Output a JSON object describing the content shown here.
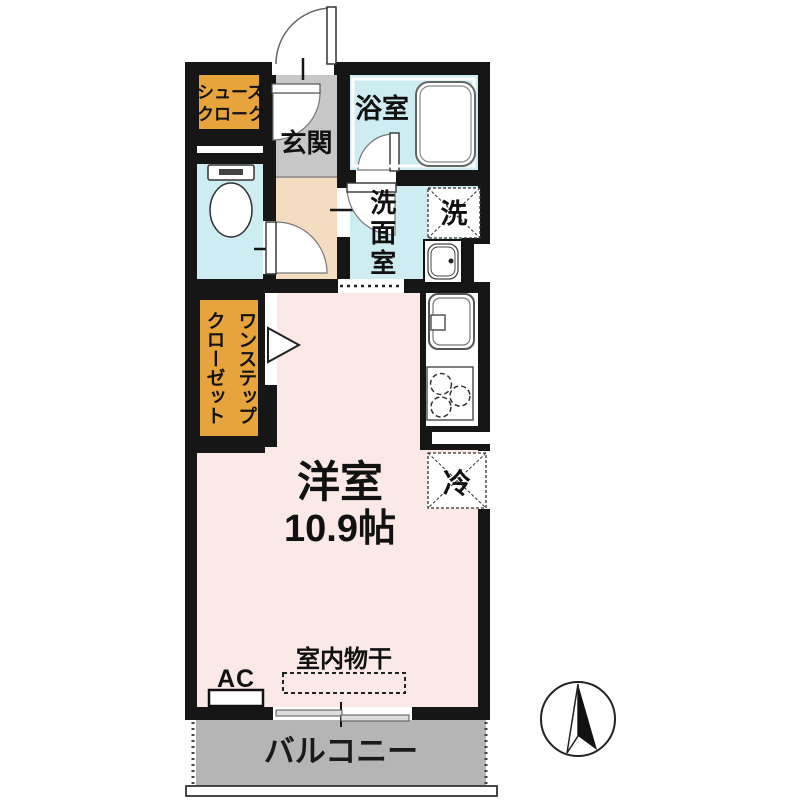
{
  "floorplan": {
    "shoe_closet": {
      "line1": "シューズ",
      "line2": "クローク"
    },
    "entrance_label": "玄関",
    "bathroom_label": "浴室",
    "washroom_label": "洗面室",
    "washer_label": "洗",
    "closet_line1": "ワンステップ",
    "closet_line2": "クローゼット",
    "main_room_label": "洋室",
    "main_room_size": "10.9帖",
    "fridge_label": "冷",
    "ac_label": "AC",
    "drying_label": "室内物干",
    "balcony_label": "バルコニー",
    "colors": {
      "accent_orange": "#E8A43C",
      "wet_area_blue": "#CDEDF2",
      "room_pink": "#FBE9E8",
      "entrance_gray": "#C7C7C7",
      "hallway_tan": "#F3DCC0",
      "balcony_gray": "#B5B5B5",
      "wall_black": "#161616"
    }
  }
}
